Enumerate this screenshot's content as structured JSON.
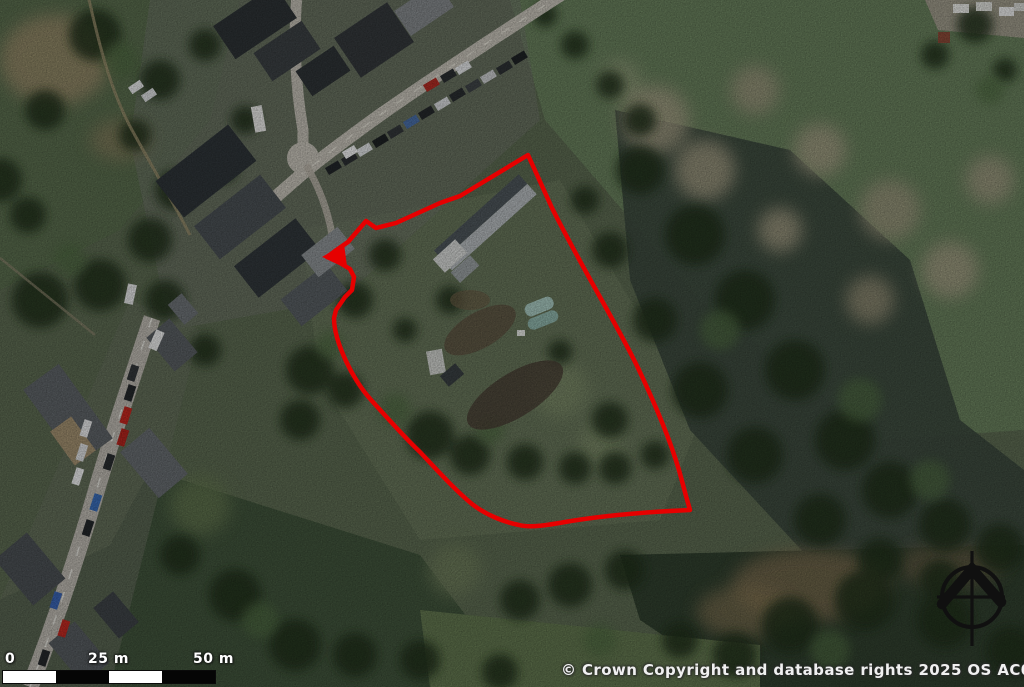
{
  "map": {
    "kind": "aerial-photograph-with-site-outline",
    "area": "village edge with fields and woodland"
  },
  "boundary": {
    "color": "#e60000",
    "stroke_width": 4.5,
    "path_d": "M 528 155 L 460 196 L 440 203 L 396 223 L 376 228 L 366 221 L 348 242 L 335 251 L 327 257 L 340 263 L 350 269 L 354 277 L 352 290 L 345 297 L 336 310 L 334 318 C 334 331 339 346 346 361 C 353 376 362 390 372 401 C 384 414 404 437 420 452 C 436 469 455 490 472 504 C 486 515 504 522 519 525 C 531 528 548 525 565 522 C 600 516 645 512 690 510 L 686 496 L 682 481 C 674 450 658 410 638 368 C 618 326 583 270 552 208 L 528 155 Z",
    "arrow_points": "322,257 344,244 347,266"
  },
  "scale_bar": {
    "labels": [
      "0",
      "25 m",
      "50 m"
    ],
    "total_meters": 50,
    "segments": 4,
    "segment_colors": [
      "#ffffff",
      "#000000"
    ]
  },
  "compass": {
    "type": "north-arrow",
    "color": "#101010"
  },
  "attribution": {
    "text": "© Crown Copyright and database rights 2025 OS AC0000829429"
  }
}
